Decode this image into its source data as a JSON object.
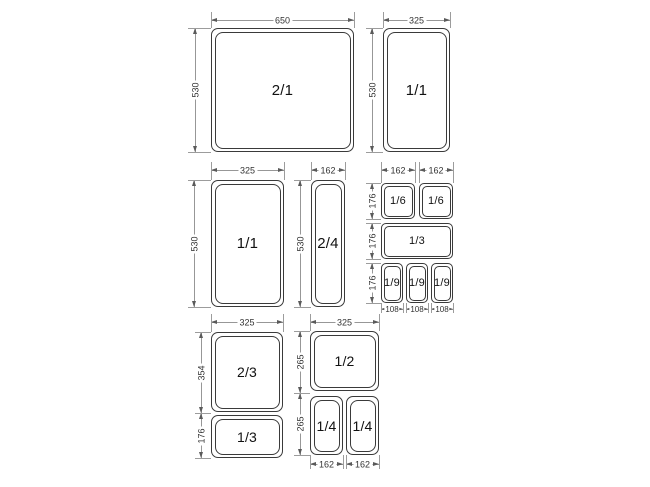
{
  "diagram": {
    "subject": "Gastronorm pan size diagram",
    "background_color": "#ffffff",
    "pan_line_color": "#3a3a3a",
    "dimension_line_color": "#979797",
    "text_color": "#111111"
  },
  "pans": [
    {
      "label": "2/1"
    },
    {
      "label": "1/1"
    },
    {
      "label": "1/1"
    },
    {
      "label": "2/4"
    },
    {
      "label": "1/6"
    },
    {
      "label": "1/6"
    },
    {
      "label": "1/3"
    },
    {
      "label": "1/9"
    },
    {
      "label": "1/9"
    },
    {
      "label": "1/9"
    },
    {
      "label": "2/3"
    },
    {
      "label": "1/3"
    },
    {
      "label": "1/2"
    },
    {
      "label": "1/4"
    },
    {
      "label": "1/4"
    }
  ],
  "dims": [
    {
      "value": "650"
    },
    {
      "value": "530"
    },
    {
      "value": "325"
    },
    {
      "value": "530"
    },
    {
      "value": "325"
    },
    {
      "value": "530"
    },
    {
      "value": "162"
    },
    {
      "value": "530"
    },
    {
      "value": "162"
    },
    {
      "value": "162"
    },
    {
      "value": "176"
    },
    {
      "value": "176"
    },
    {
      "value": "176"
    },
    {
      "value": "108"
    },
    {
      "value": "108"
    },
    {
      "value": "108"
    },
    {
      "value": "325"
    },
    {
      "value": "354"
    },
    {
      "value": "176"
    },
    {
      "value": "325"
    },
    {
      "value": "265"
    },
    {
      "value": "265"
    },
    {
      "value": "162"
    },
    {
      "value": "162"
    }
  ]
}
